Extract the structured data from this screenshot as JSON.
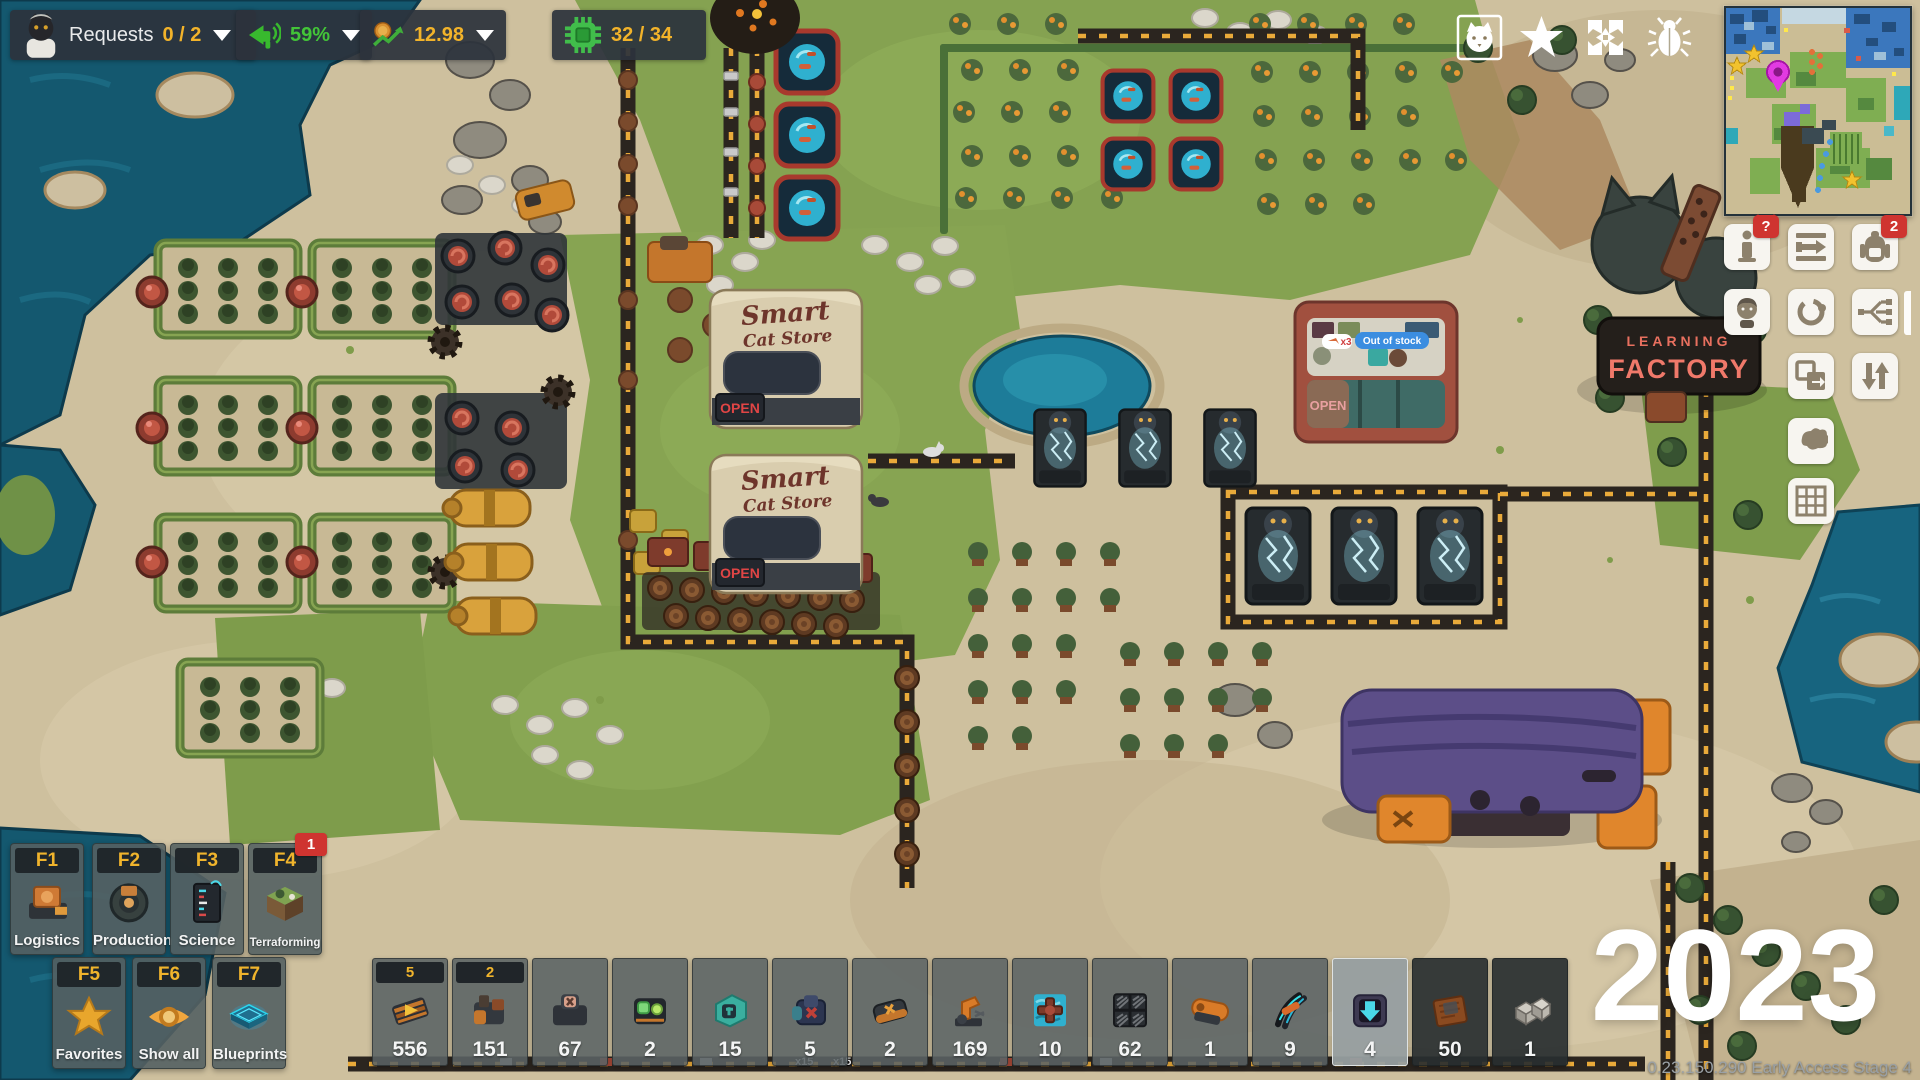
{
  "hud": {
    "requests": {
      "label": "Requests",
      "value": "0 / 2"
    },
    "audience": {
      "value": "59%"
    },
    "money": {
      "value": "12.98"
    },
    "cpu": {
      "value": "32 / 34"
    }
  },
  "right_toolbar": {
    "info_badge": "?",
    "backpack_badge": "2"
  },
  "categories": [
    {
      "key": "F1",
      "label": "Logistics"
    },
    {
      "key": "F2",
      "label": "Production"
    },
    {
      "key": "F3",
      "label": "Science"
    },
    {
      "key": "F4",
      "label": "Terraforming",
      "badge": "1"
    },
    {
      "key": "F5",
      "label": "Favorites"
    },
    {
      "key": "F6",
      "label": "Show all"
    },
    {
      "key": "F7",
      "label": "Blueprints"
    }
  ],
  "hotbar": {
    "slots": [
      {
        "badge": "5",
        "count": "556"
      },
      {
        "badge": "2",
        "count": "151"
      },
      {
        "count": "67"
      },
      {
        "count": "2"
      },
      {
        "count": "15"
      },
      {
        "count": "5"
      },
      {
        "count": "2"
      },
      {
        "count": "169"
      },
      {
        "count": "10"
      },
      {
        "count": "62"
      },
      {
        "count": "1"
      },
      {
        "count": "9"
      },
      {
        "count": "4"
      },
      {
        "count": "50"
      },
      {
        "count": "1"
      }
    ]
  },
  "overlay": {
    "year": "2023",
    "version": "0.23.150.290 Early Access Stage 4"
  },
  "world": {
    "store_sign_line1": "Smart",
    "store_sign_line2": "Cat Store",
    "open_sign": "OPEN",
    "monument_line1": "LEARNING",
    "monument_line2": "FACTORY",
    "bubble_out_of_stock": "Out of stock",
    "bubble_fish_count": "x3",
    "ground_label": "x15"
  },
  "icons": {
    "top_right": [
      "cat-portrait",
      "star",
      "center-view",
      "bug"
    ],
    "right_toolbar": [
      "milestones-info",
      "export-belt",
      "backpack",
      "portrait",
      "rotate",
      "flow-graph",
      "copy",
      "sort-vertical",
      "island",
      "grid"
    ]
  },
  "colors": {
    "accent_gold": "#f2b32a",
    "accent_green": "#43c538",
    "badge_red": "#cf3430",
    "neon_sign": "#f0796a",
    "water": "#14586f"
  }
}
